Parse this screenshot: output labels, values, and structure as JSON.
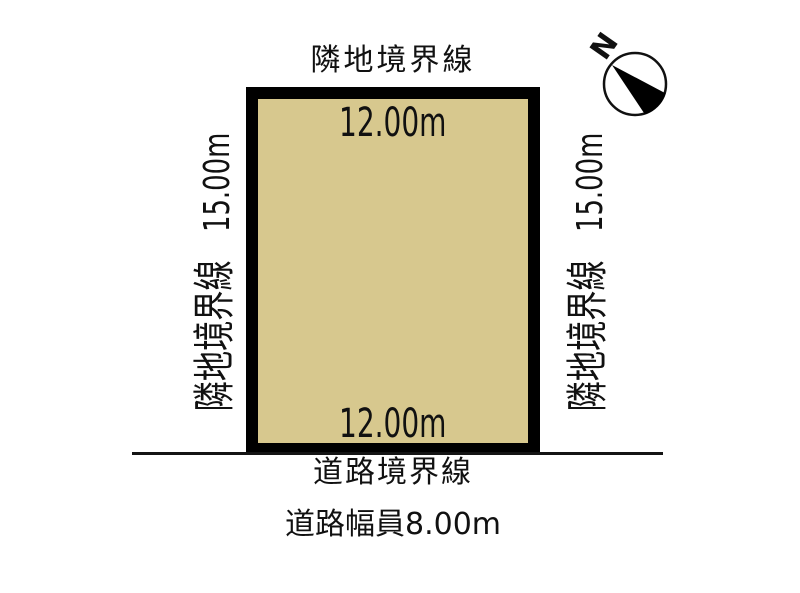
{
  "diagram": {
    "compass": {
      "label": "N"
    },
    "plot": {
      "fill_color": "#d7c88e",
      "border_color": "#000000",
      "top": {
        "boundary_label": "隣地境界線",
        "dimension": "12.00m"
      },
      "bottom": {
        "dimension": "12.00m"
      },
      "left": {
        "boundary_label": "隣地境界線",
        "dimension": "15.00m"
      },
      "right": {
        "boundary_label": "隣地境界線",
        "dimension": "15.00m"
      }
    },
    "road": {
      "boundary_label": "道路境界線",
      "width_label": "道路幅員8.00m"
    }
  }
}
